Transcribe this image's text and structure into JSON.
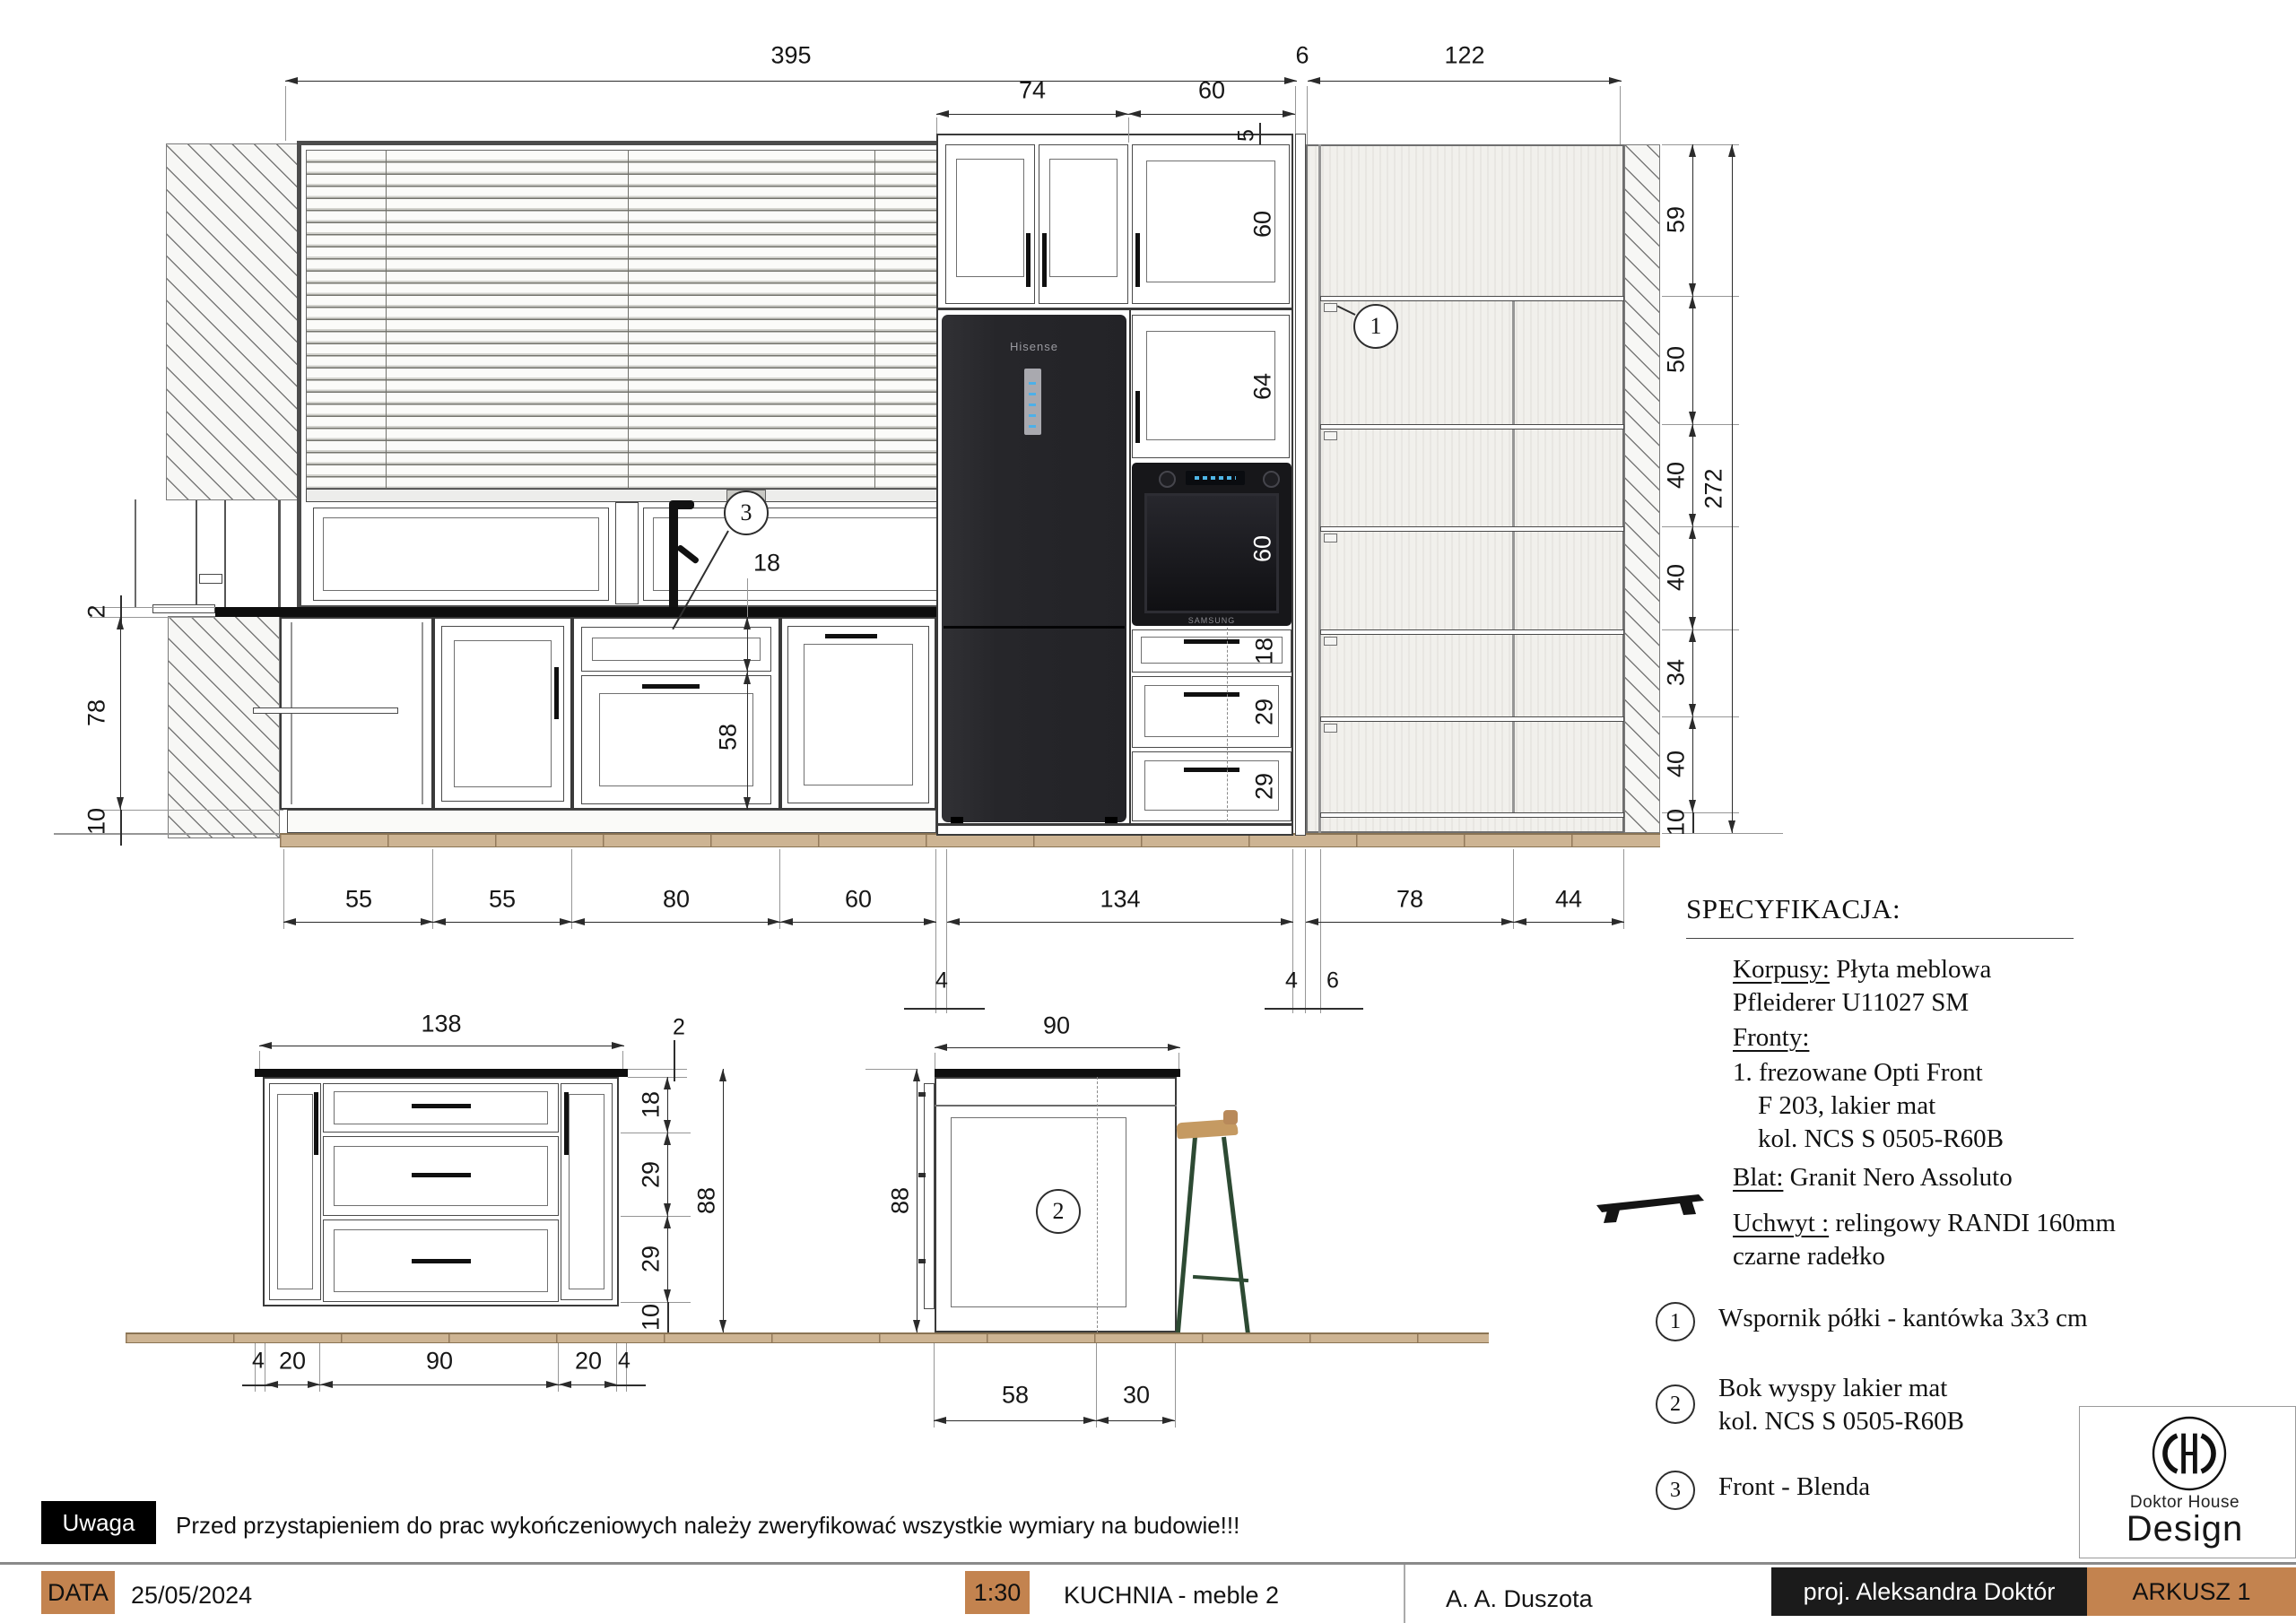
{
  "colors": {
    "accent_tan": "#c3834f",
    "floor_wood": "#cdb493",
    "stool_green": "#2d4a33",
    "stool_seat": "#c59a62",
    "counter_black": "#0e0e0e"
  },
  "elevation": {
    "dims_top": {
      "d395": "395",
      "d6": "6",
      "d122": "122",
      "d74": "74",
      "d60": "60",
      "d5": "5"
    },
    "dims_right": [
      "59",
      "50",
      "40",
      "40",
      "34",
      "40",
      "10"
    ],
    "dim_total_height": "272",
    "dims_left": {
      "d2": "2",
      "d78": "78",
      "d10": "10"
    },
    "dims_bottom": [
      "55",
      "55",
      "80",
      "60",
      "134",
      "78",
      "44"
    ],
    "dims_bottom_sub": [
      "4",
      "4",
      "6"
    ],
    "dims_sink": {
      "d18": "18",
      "d58": "58"
    },
    "dims_tall_column": [
      "60",
      "64",
      "60",
      "18",
      "29",
      "29"
    ],
    "fridge_brand": "Hisense",
    "oven_brand": "SAMSUNG",
    "callout_1": "1",
    "callout_3": "3"
  },
  "island_front": {
    "dims": {
      "width": "138",
      "counter": "2",
      "rows": [
        "18",
        "29",
        "29",
        "10"
      ],
      "height": "88",
      "bottom": [
        "4",
        "20",
        "90",
        "20",
        "4"
      ]
    }
  },
  "island_side": {
    "dims": {
      "width": "90",
      "height": "88",
      "bottom": [
        "58",
        "30"
      ]
    },
    "callout_2": "2"
  },
  "spec": {
    "title": "SPECYFIKACJA:",
    "korpusy_label": "Korpusy:",
    "korpusy_text": " Płyta meblowa",
    "korpusy_line2": "Pfleiderer U11027 SM",
    "fronty_label": "Fronty:",
    "fronty_item1": "1. frezowane Opti Front",
    "fronty_item2": "F 203, lakier mat",
    "fronty_item3": "kol. NCS  S 0505-R60B",
    "blat_label": "Blat:",
    "blat_text": " Granit Nero Assoluto",
    "uchwyt_label": "Uchwyt :",
    "uchwyt_text": " relingowy  RANDI 160mm",
    "uchwyt_line2": "czarne radełko"
  },
  "notes": [
    {
      "num": "1",
      "text": "Wspornik półki - kantówka 3x3 cm"
    },
    {
      "num": "2",
      "text": "Bok wyspy lakier mat",
      "text2": "kol. NCS S 0505-R60B"
    },
    {
      "num": "3",
      "text": "Front - Blenda"
    }
  ],
  "logo": {
    "line1": "Doktor House",
    "line2": "Design"
  },
  "warning": {
    "label": "Uwaga",
    "text": "Przed przystapieniem do prac wykończeniowych należy zweryfikować wszystkie wymiary na budowie!!!"
  },
  "titleblock": {
    "data_label": "DATA",
    "date": "25/05/2024",
    "scale": "1:30",
    "title": "KUCHNIA - meble 2",
    "author": "A. A. Duszota",
    "designer": "proj. Aleksandra Doktór",
    "sheet": "ARKUSZ 1"
  }
}
